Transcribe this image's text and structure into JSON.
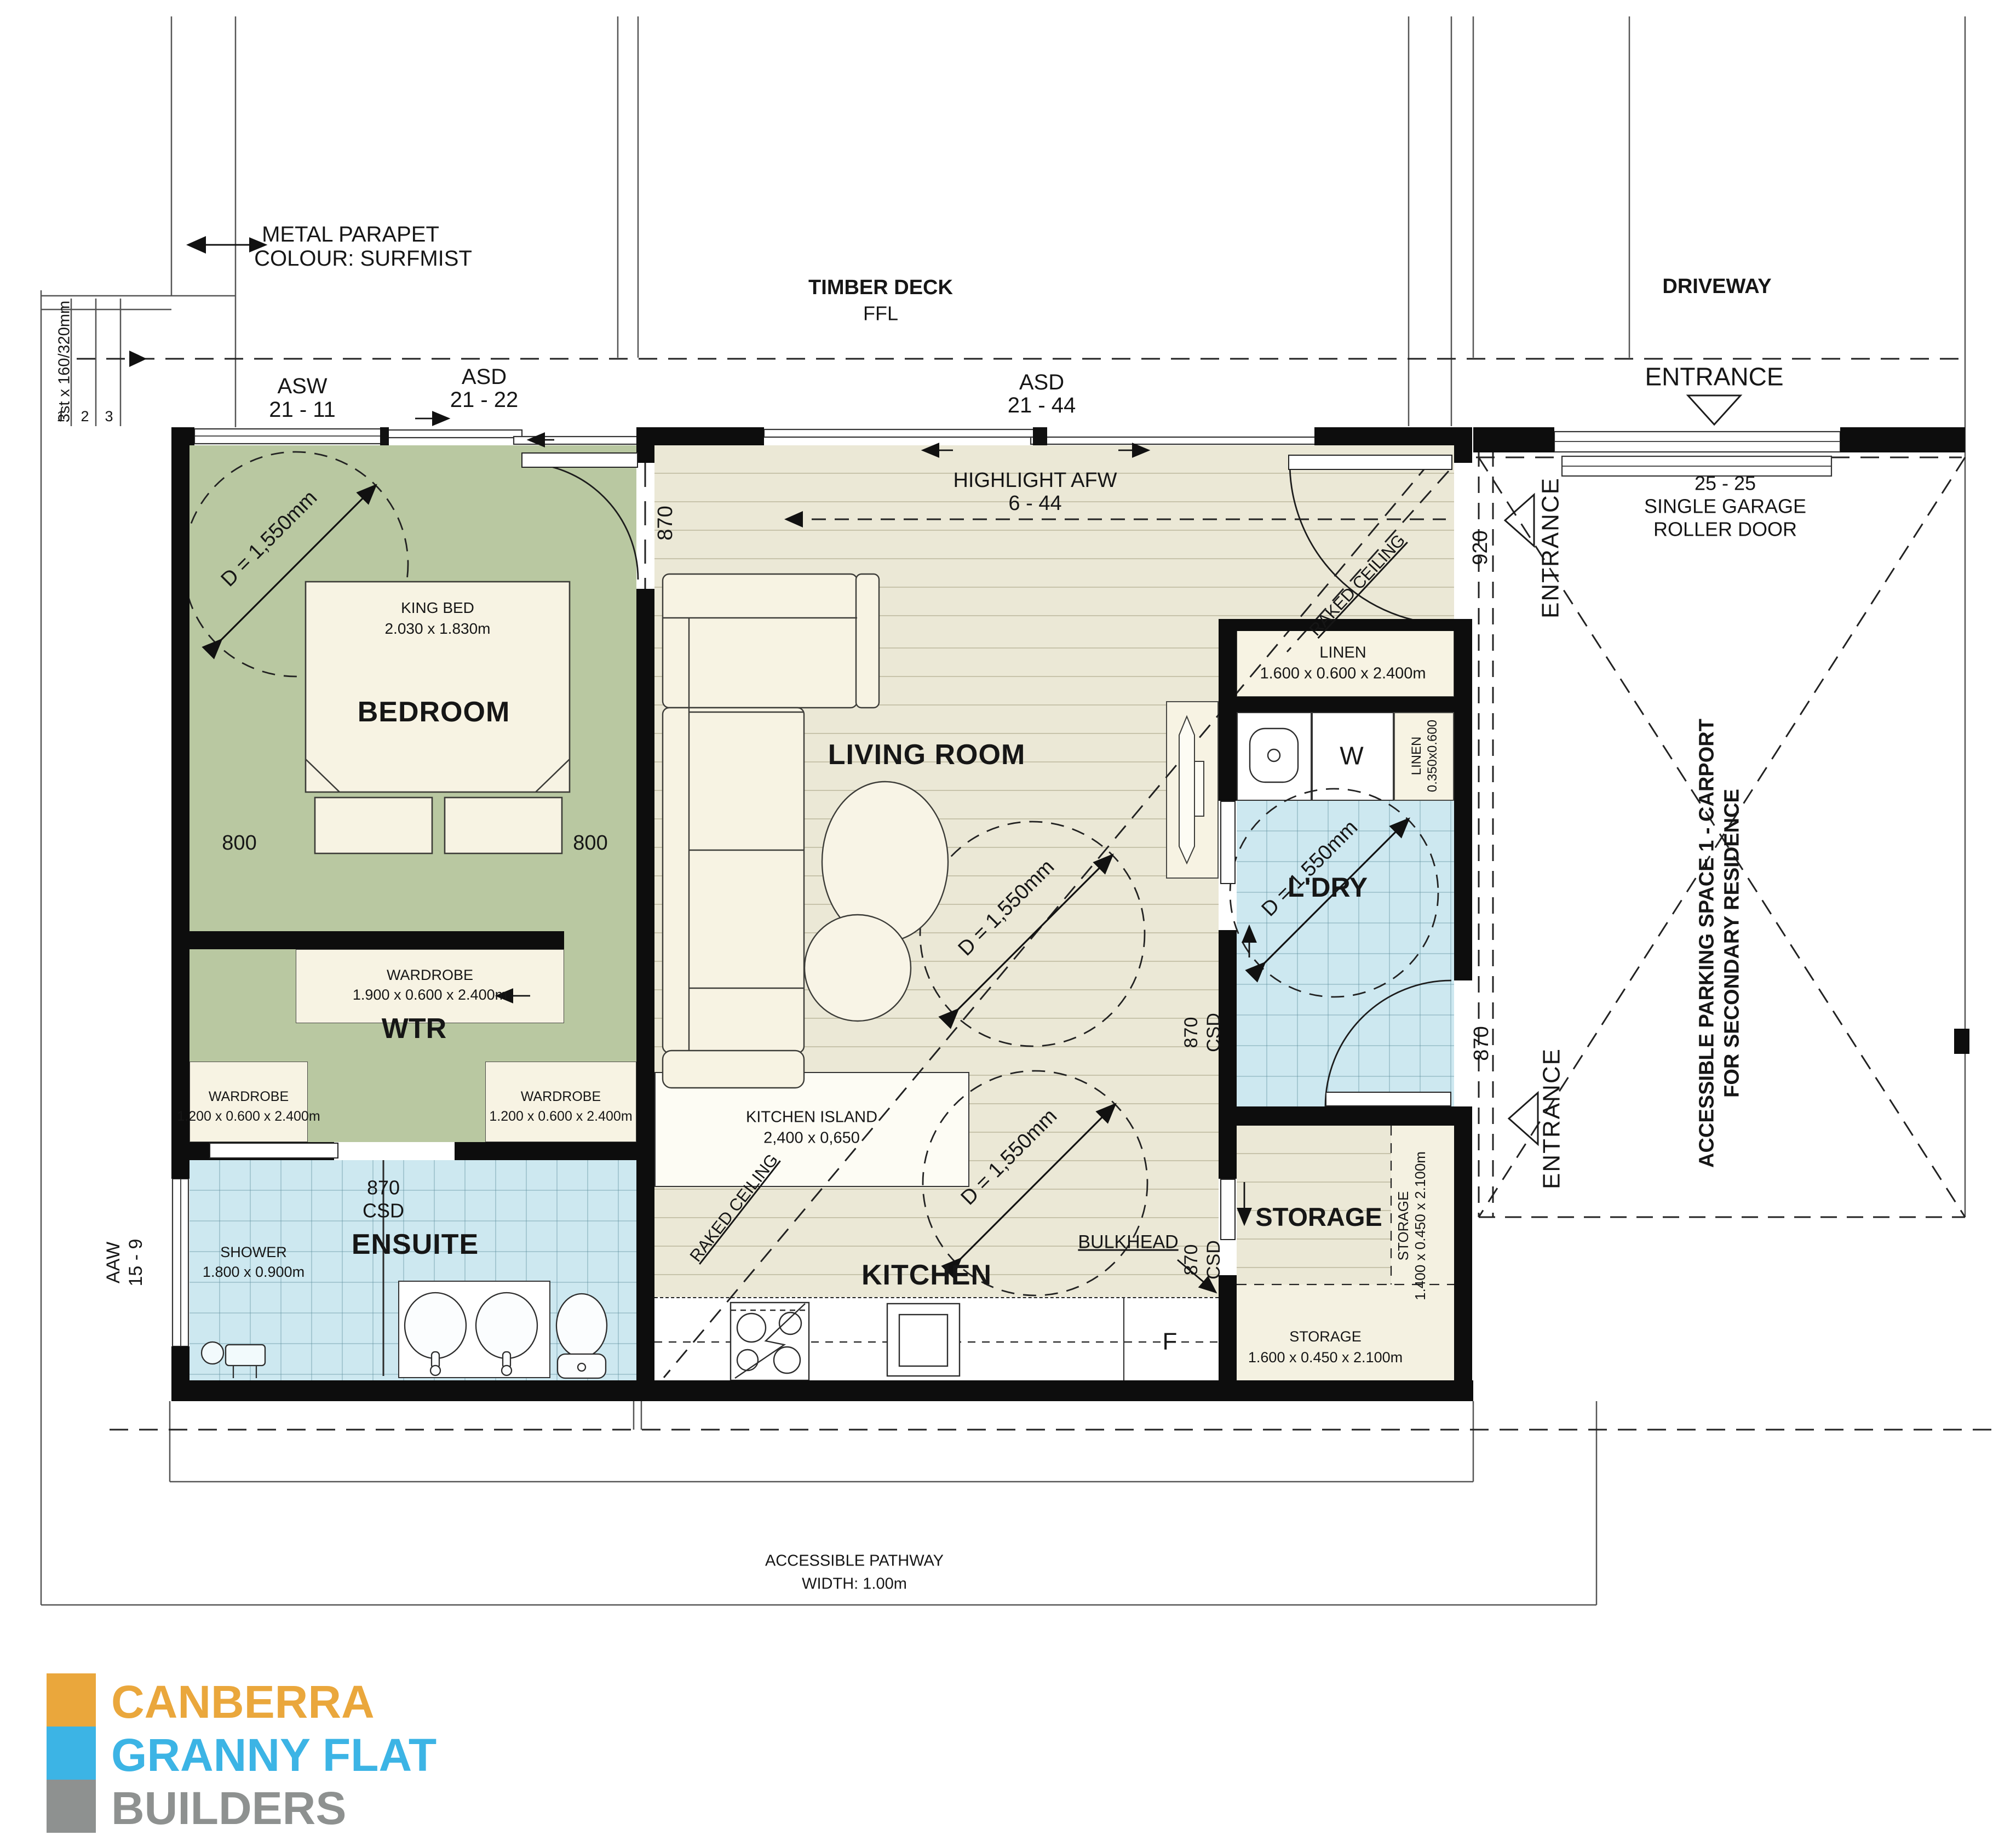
{
  "site": {
    "metal_parapet_line1": "METAL PARAPET",
    "metal_parapet_line2": "COLOUR: SURFMIST",
    "stair_note": "3st x 160/320mm",
    "step_1": "1",
    "step_2": "2",
    "step_3": "3",
    "timber_deck": "TIMBER DECK",
    "ffl": "FFL",
    "driveway": "DRIVEWAY",
    "entrance_top": "ENTRANCE",
    "entrance_side_upper": "ENTRANCE",
    "entrance_side_lower": "ENTRANCE",
    "garage_line1": "25 - 25",
    "garage_line2": "SINGLE GARAGE",
    "garage_line3": "ROLLER DOOR",
    "carport_line1": "ACCESSIBLE PARKING SPACE 1 - CARPORT",
    "carport_line2": "FOR SECONDARY RESIDENCE",
    "pathway_line1": "ACCESSIBLE PATHWAY",
    "pathway_line2": "WIDTH: 1.00m"
  },
  "windows": {
    "asw_name": "ASW",
    "asw_id": "21 - 11",
    "asd_bed_name": "ASD",
    "asd_bed_id": "21 - 22",
    "asd_living_name": "ASD",
    "asd_living_id": "21 - 44",
    "highlight_name": "HIGHLIGHT AFW",
    "highlight_id": "6 - 44",
    "aaw_name": "AAW",
    "aaw_id": "15 - 9"
  },
  "rooms": {
    "bedroom": "BEDROOM",
    "wtr": "WTR",
    "living": "LIVING ROOM",
    "kitchen": "KITCHEN",
    "ensuite": "ENSUITE",
    "ldry": "L'DRY",
    "storage": "STORAGE"
  },
  "fixtures": {
    "king_bed_name": "KING BED",
    "king_bed_size": "2.030 x 1.830m",
    "wardrobe_main_name": "WARDROBE",
    "wardrobe_main_size": "1.900 x 0.600 x 2.400m",
    "wardrobe_left_name": "WARDROBE",
    "wardrobe_left_size": "1.200 x 0.600 x 2.400m",
    "wardrobe_right_name": "WARDROBE",
    "wardrobe_right_size": "1.200 x 0.600 x 2.400m",
    "shower_name": "SHOWER",
    "shower_size": "1.800 x 0.900m",
    "island_name": "KITCHEN ISLAND",
    "island_size": "2,400 x 0,650",
    "linen_name": "LINEN",
    "linen_size": "1.600 x 0.600 x 2.400m",
    "linen_small_name": "LINEN",
    "linen_small_size": "0.350x0.600",
    "storage_tall_name": "STORAGE",
    "storage_tall_size": "1.400 x 0.450 x 2.100m",
    "storage_low_name": "STORAGE",
    "storage_low_size": "1.600 x 0.450 x 2.100m",
    "washer": "W",
    "fridge": "F",
    "bulkhead": "BULKHEAD"
  },
  "dims": {
    "turning_circle": "D = 1,550mm",
    "bed_left": "800",
    "bed_right": "800",
    "bed_door": "870",
    "wtr_csd_w": "870",
    "wtr_csd": "CSD",
    "k1_w": "870",
    "k1_csd": "CSD",
    "k2_w": "870",
    "k2_csd": "CSD",
    "entry_width": "920",
    "ldry_door": "870",
    "raked_1": "RAKED CEILING",
    "raked_2": "RAKED CEILING"
  },
  "logo": {
    "line1": "CANBERRA",
    "line2": "GRANNY FLAT",
    "line3": "BUILDERS",
    "colors": {
      "orange": "#EAA73C",
      "blue": "#3CB4E5",
      "gray": "#8E9190"
    }
  }
}
